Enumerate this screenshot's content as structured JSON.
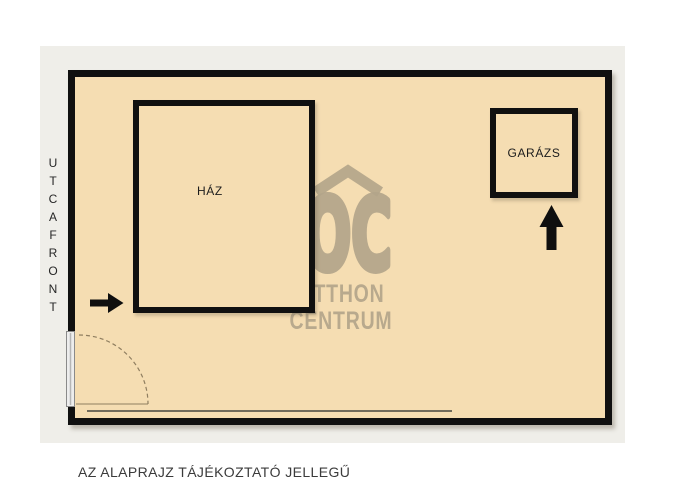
{
  "plan": {
    "street_front_label": "UTCAFRONT",
    "house_label": "HÁZ",
    "garage_label": "GARÁZS",
    "caption": "AZ ALAPRAJZ TÁJÉKOZTATÓ JELLEGŰ"
  },
  "watermark": {
    "logo": "OC",
    "line1": "OTTHON",
    "line2": "CENTRUM"
  },
  "colors": {
    "panel_background": "#efeee9",
    "plot_fill": "#f5ddb2",
    "outline_black": "#101010",
    "watermark_tan": "#b3a58a",
    "caption_text": "#3b3b3b",
    "gate_arc": "#8f7e60"
  },
  "icons": {
    "roof": "chevron-roof-icon",
    "house_entrance": "arrow-right-icon",
    "garage_entrance": "arrow-up-icon",
    "gate": "door-swing-arc"
  }
}
